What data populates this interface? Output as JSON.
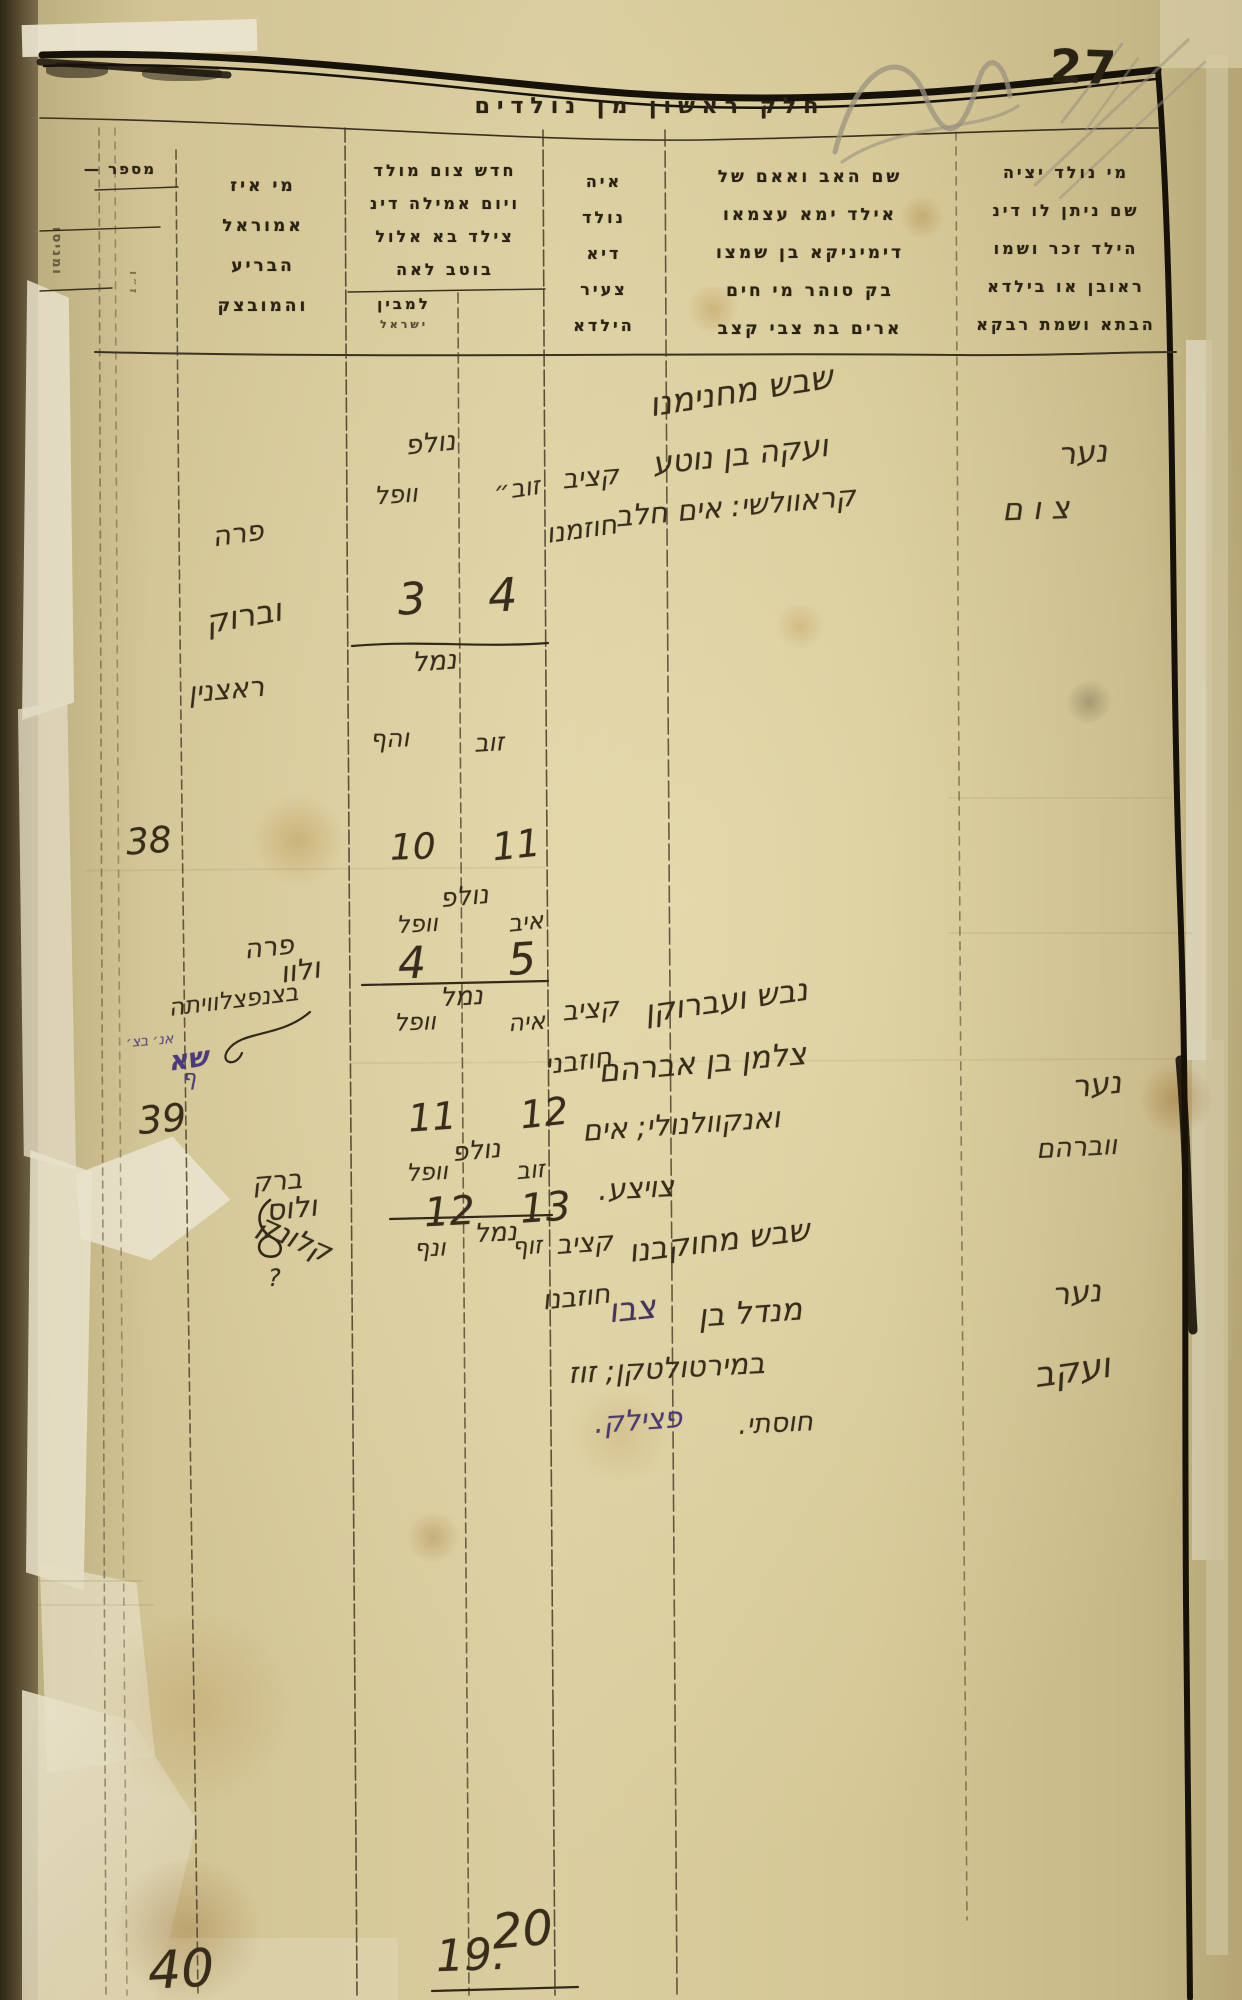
{
  "page": {
    "number_label": "27",
    "title": "חלק ראשון מן נולדים"
  },
  "header": {
    "number_col": {
      "label": "מספר —",
      "side_note": "ומניסו",
      "side_note2": "ז״ו"
    },
    "midwife_col": {
      "line1": "מי איז",
      "line2": "אמוראל",
      "line3": "הבריע",
      "line4": "והמובצק"
    },
    "dates_col": {
      "line1": "חדש צום מולד",
      "line2": "ויום אמילה דינ",
      "line3": "צילד בא אלול",
      "line4": "בוטב לאה",
      "sub1": "למבין",
      "sub2": "ישראל"
    },
    "where_col": {
      "line1": "איה",
      "line2": "נולד",
      "line3": "דיא",
      "line4": "צעיר",
      "line5": "הילדא"
    },
    "parents_col": {
      "line1": "שם האב ואאם של",
      "line2": "אילד ימא עצמאו",
      "line3": "דימיניקא בן שמצו",
      "line4": "בק סוהר מי חים",
      "line5": "ארים בת צבי קצב"
    },
    "child_col": {
      "line1": "מי נולד יציה",
      "line2": "שם ניתן לו דינ",
      "line3": "הילד זכר ושמו",
      "line4": "ראובן או בילדא",
      "line5": "הבתא ושמת רבקא"
    }
  },
  "entries": [
    {
      "row": "38",
      "parents": {
        "l1": "שבש מחנימנו",
        "l2": "ועקה בן נוטע",
        "l3": "קראוולשי: אים חלב"
      },
      "child": {
        "sex": "נער",
        "name": "צום"
      },
      "where": {
        "l1": "קציב",
        "l2": "חוזמנו"
      },
      "dates": {
        "born": "נולפ",
        "born_day_r": "זוב״",
        "born_day_l": "וופל",
        "born_n_l": "3",
        "born_n_r": "4",
        "milah": "נמל",
        "milah_day_r": "זוב",
        "milah_day_l": "והף",
        "milah_n_l": "10",
        "milah_n_r": "11"
      },
      "midwife": {
        "l1": "פרה",
        "l2": "וברוק",
        "l3": "ראצנין"
      }
    },
    {
      "row": "39",
      "parents": {
        "l1": "נבש ועברוקן",
        "l2": "צלמן בן אברהם",
        "l3": "ואנקוולנולי; אים",
        "l4": "צויצע."
      },
      "child": {
        "sex": "נער",
        "name": "ווברהם"
      },
      "where": {
        "l1": "קציב",
        "l2": "חוזבני"
      },
      "dates": {
        "born": "נולפ",
        "born_day_r": "איב",
        "born_day_l": "וופל",
        "born_n_l": "4",
        "born_n_r": "5",
        "milah": "נמל",
        "milah_day_r": "איה",
        "milah_day_l": "וופל",
        "milah_n_l": "11",
        "milah_n_r": "12"
      },
      "midwife": {
        "l1": "פרה",
        "l2": "ולוו",
        "l3": "בצנפצלוויתה"
      }
    },
    {
      "row": "40",
      "parents": {
        "l1": "שבש מחוקבנו",
        "l2_ink": "מנדל בן",
        "l2_purple": "צבו",
        "l3": "במירטולטקן; זוז",
        "l4_ink": "חוסתי.",
        "l4_purple": "פצילק."
      },
      "child": {
        "sex": "נער",
        "name": "ועקב"
      },
      "where": {
        "l1": "קציב",
        "l2": "חוזבנו"
      },
      "dates": {
        "born": "נולפ",
        "born_day_r": "זוב",
        "born_day_l": "וופל",
        "born_n_l": "12",
        "born_n_r": "13",
        "milah": "נמל",
        "milah_day_r": "זוף",
        "milah_day_l": "ונף",
        "milah_n_l": "19.",
        "milah_n_r": "20"
      },
      "midwife": {
        "l1": "ברק",
        "l2": "ולוס",
        "l3": "קלונק",
        "mark": "?"
      }
    }
  ],
  "annotations": {
    "purple_l1": "אנ׳ בצ׳",
    "purple_l2": "שא",
    "purple_l3": "ף"
  }
}
